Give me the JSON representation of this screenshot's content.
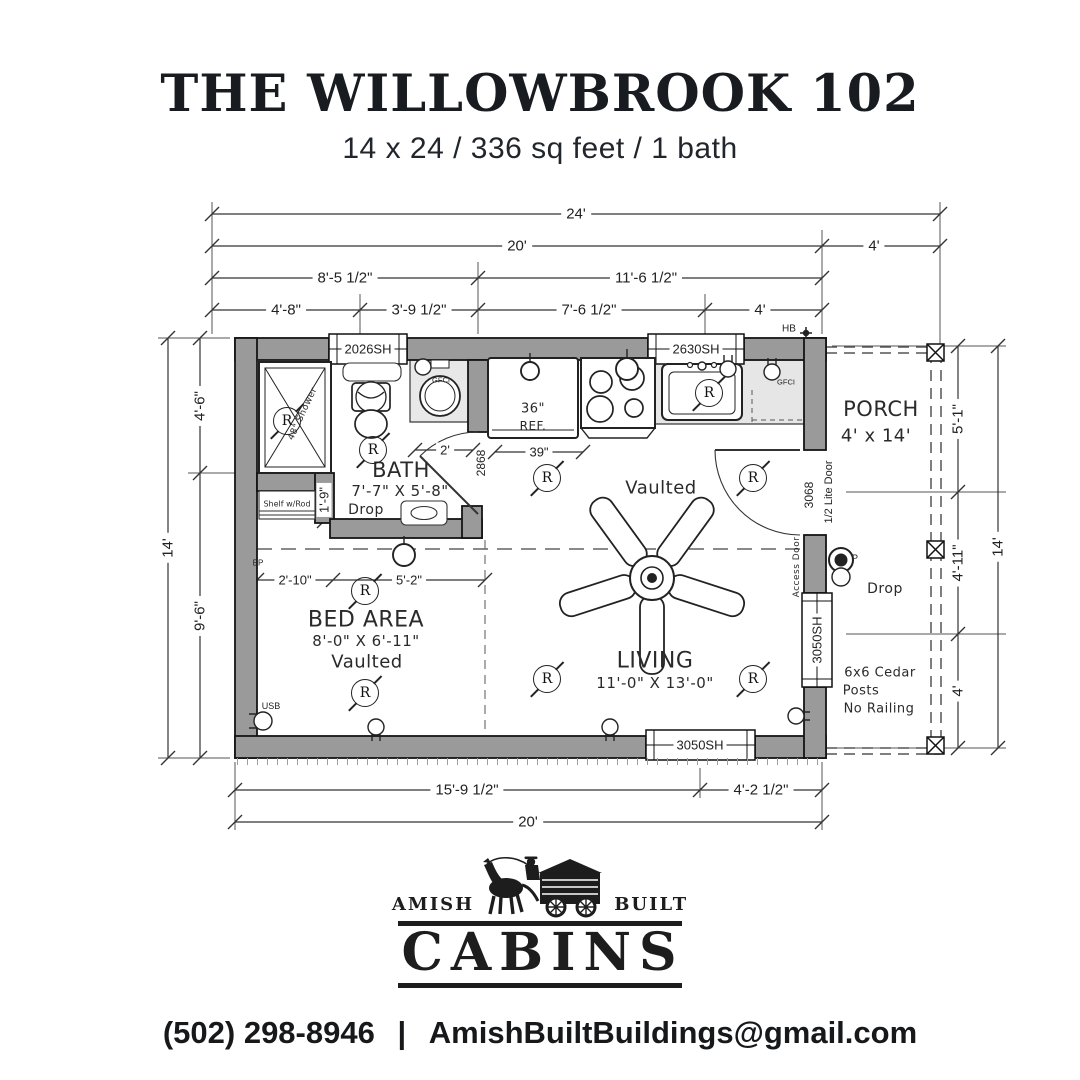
{
  "header": {
    "title": "THE WILLOWBROOK 102",
    "subtitle": "14 x 24 / 336 sq feet / 1 bath"
  },
  "plan": {
    "rooms": {
      "bath": {
        "name": "BATH",
        "size": "7'-7\" X 5'-8\"",
        "note": "Drop"
      },
      "bed": {
        "name": "BED AREA",
        "size": "8'-0\" X 6'-11\"",
        "note": "Vaulted"
      },
      "living": {
        "name": "LIVING",
        "size": "11'-0\" X 13'-0\"",
        "note": "Vaulted"
      },
      "porch": {
        "name": "PORCH",
        "size": "4' x 14'",
        "drop_note": "Drop",
        "posts_line1": "6x6 Cedar",
        "posts_line2": "Posts",
        "posts_line3": "No Railing"
      }
    },
    "windows": {
      "top_left": "2026SH",
      "top_right": "2630SH",
      "bottom": "3050SH",
      "right": "3050SH"
    },
    "doors": {
      "front_size": "3068",
      "front_type": "1/2 Lite Door",
      "bath": "2868",
      "access": "Access Door"
    },
    "dims": {
      "top_total": "24'",
      "top_main": "20'",
      "top_porch": "4'",
      "mid_left": "8'-5 1/2\"",
      "mid_right": "11'-6 1/2\"",
      "seg1": "4'-8\"",
      "seg2": "3'-9 1/2\"",
      "seg3": "7'-6 1/2\"",
      "seg4": "4'",
      "left_top": "4'-6\"",
      "left_bottom": "9'-6\"",
      "left_total": "14'",
      "right_top": "5'-1\"",
      "right_mid": "4'-11\"",
      "right_bottom": "4'",
      "right_total": "14'",
      "bottom_left": "15'-9 1/2\"",
      "bottom_right": "4'-2 1/2\"",
      "bottom_total": "20'",
      "fridge_width": "39\"",
      "sink_offset": "2'",
      "closet_depth": "1'-9\"",
      "bed_left": "2'-10\"",
      "bed_right": "5'-2\""
    },
    "fixtures": {
      "fridge_size": "36\"",
      "fridge_label": "REF.",
      "shower_label": "48\" Shower",
      "closet_label": "Shelf w/Rod",
      "gfci": "GFCI",
      "hose_bib": "HB",
      "electric_panel": "EP",
      "usb": "USB",
      "meter": "P",
      "recessed_light": "R"
    }
  },
  "logo": {
    "word_left": "AMISH",
    "word_right": "BUILT",
    "word_main": "CABINS"
  },
  "footer": {
    "phone": "(502) 298-8946",
    "separator": "|",
    "email": "AmishBuiltBuildings@gmail.com"
  }
}
